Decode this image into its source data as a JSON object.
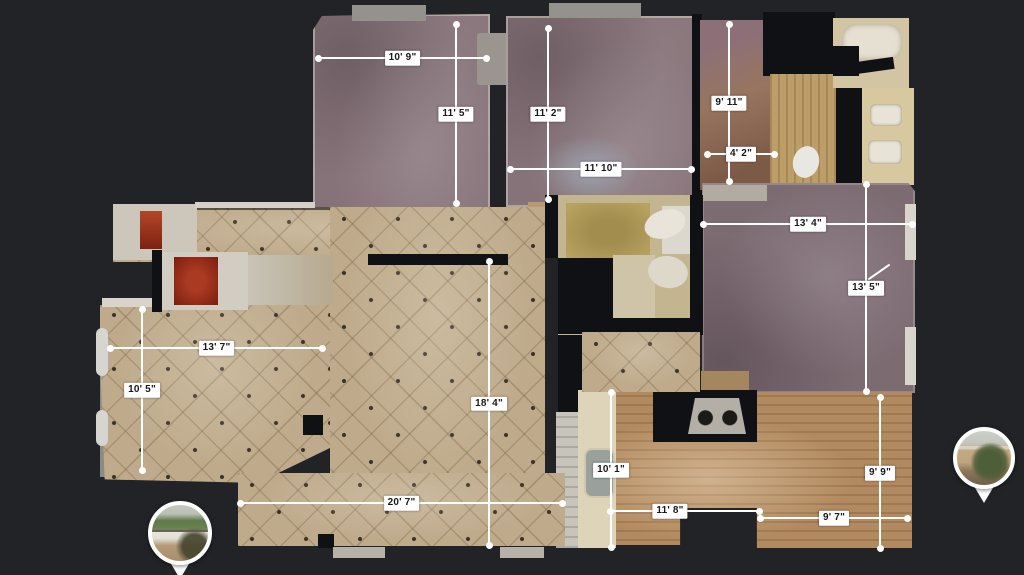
{
  "view": {
    "type": "floorplan-top-down",
    "background_color": "#212327",
    "line_color": "#ffffff",
    "label_bg": "#ffffff",
    "label_text_color": "#181818"
  },
  "measurements": [
    {
      "id": "bedroom1-width",
      "orientation": "horizontal",
      "label": "10' 9\""
    },
    {
      "id": "bedroom1-depth",
      "orientation": "vertical",
      "label": "11' 5\""
    },
    {
      "id": "bedroom2-depth",
      "orientation": "vertical",
      "label": "11' 2\""
    },
    {
      "id": "bedroom2-width",
      "orientation": "horizontal",
      "label": "11' 10\""
    },
    {
      "id": "bath-depth",
      "orientation": "vertical",
      "label": "9' 11\""
    },
    {
      "id": "bath-width",
      "orientation": "horizontal",
      "label": "4' 2\""
    },
    {
      "id": "master-width",
      "orientation": "horizontal",
      "label": "13' 4\""
    },
    {
      "id": "master-depth",
      "orientation": "vertical",
      "label": "13' 5\""
    },
    {
      "id": "dining-width",
      "orientation": "horizontal",
      "label": "13' 7\""
    },
    {
      "id": "dining-depth",
      "orientation": "vertical",
      "label": "10' 5\""
    },
    {
      "id": "living-depth",
      "orientation": "vertical",
      "label": "18' 4\""
    },
    {
      "id": "living-width",
      "orientation": "horizontal",
      "label": "20' 7\""
    },
    {
      "id": "kitchen-depth",
      "orientation": "vertical",
      "label": "10' 1\""
    },
    {
      "id": "kitchen-width",
      "orientation": "horizontal",
      "label": "11' 8\""
    },
    {
      "id": "office-depth",
      "orientation": "vertical",
      "label": "9' 9\""
    },
    {
      "id": "office-width",
      "orientation": "horizontal",
      "label": "9' 7\""
    }
  ],
  "pins": [
    {
      "id": "panorama-pin-left",
      "icon": "panorama-pin-icon",
      "thumbnail": "house-exterior-driveway"
    },
    {
      "id": "panorama-pin-right",
      "icon": "panorama-pin-icon",
      "thumbnail": "house-exterior-garden"
    }
  ],
  "floor_colors": {
    "carpet": "#867379",
    "carpet_master": "#7d6b72",
    "tile": "#bfab8c",
    "wood": "#b28a5f",
    "wall": "#101114"
  }
}
